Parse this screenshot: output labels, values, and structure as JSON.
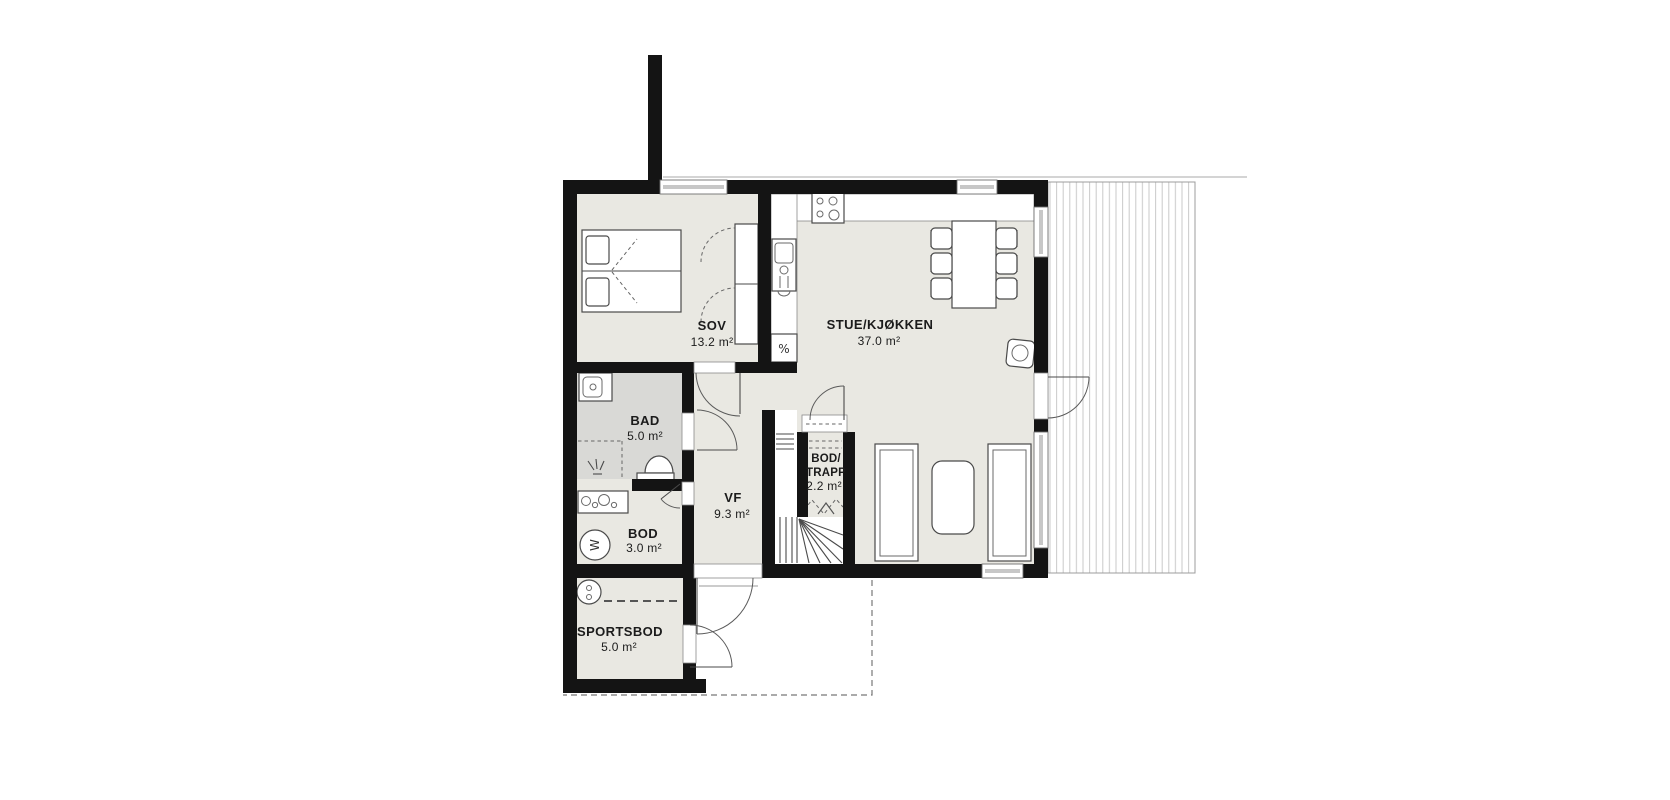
{
  "plan": {
    "type": "residential-floor-plan",
    "rooms": [
      {
        "key": "sov",
        "name": "SOV",
        "area": "13.2 m²"
      },
      {
        "key": "stue-kjokken",
        "name": "STUE/KJØKKEN",
        "area": "37.0 m²"
      },
      {
        "key": "bad",
        "name": "BAD",
        "area": "5.0 m²"
      },
      {
        "key": "vf",
        "name": "VF",
        "area": "9.3 m²"
      },
      {
        "key": "bod",
        "name": "BOD",
        "area": "3.0 m²"
      },
      {
        "key": "bod-trapp",
        "name_line1": "BOD/",
        "name_line2": "TRAPP",
        "area": "2.2 m²"
      },
      {
        "key": "sportsbod",
        "name": "SPORTSBOD",
        "area": "5.0 m²"
      }
    ],
    "symbols": {
      "dishwasher": "%",
      "washing_machine": "W"
    },
    "colors": {
      "wall": "#141414",
      "floor": "#e9e8e2",
      "bathroom_floor": "#d9d9d6",
      "deck_line": "#c9c9c9",
      "furniture_outline": "#4a4a4a"
    }
  }
}
